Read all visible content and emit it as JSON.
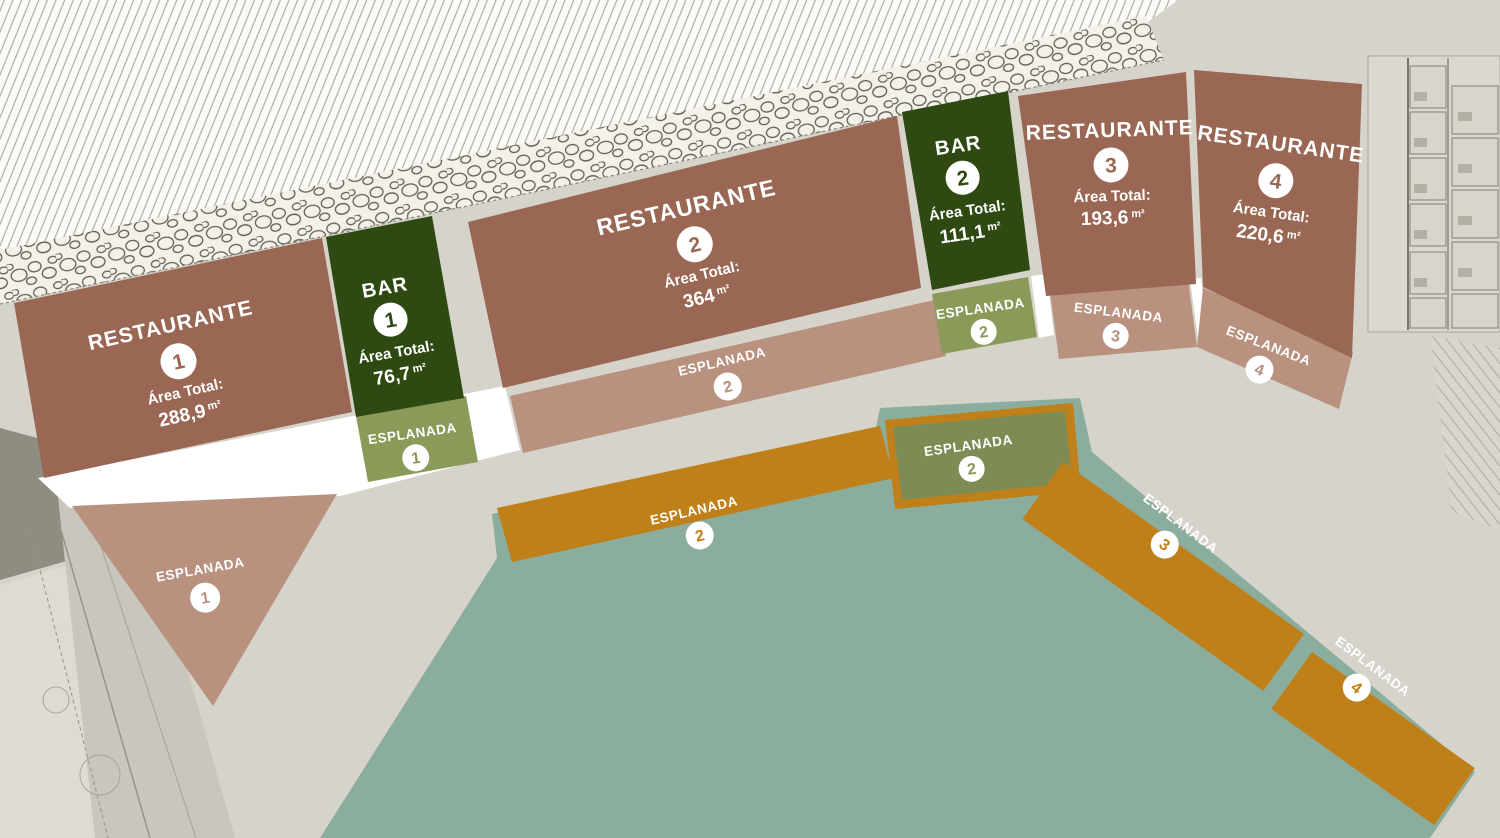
{
  "plan": {
    "zones": {
      "restaurante1": {
        "name": "RESTAURANTE",
        "number": "1",
        "area_label": "Área Total:",
        "area_value": "288,9",
        "area_unit": "m²"
      },
      "bar1": {
        "name": "BAR",
        "number": "1",
        "area_label": "Área Total:",
        "area_value": "76,7",
        "area_unit": "m²"
      },
      "restaurante2": {
        "name": "RESTAURANTE",
        "number": "2",
        "area_label": "Área Total:",
        "area_value": "364",
        "area_unit": "m²"
      },
      "bar2": {
        "name": "BAR",
        "number": "2",
        "area_label": "Área Total:",
        "area_value": "111,1",
        "area_unit": "m²"
      },
      "restaurante3": {
        "name": "RESTAURANTE",
        "number": "3",
        "area_label": "Área Total:",
        "area_value": "193,6",
        "area_unit": "m²"
      },
      "restaurante4": {
        "name": "RESTAURANTE",
        "number": "4",
        "area_label": "Área Total:",
        "area_value": "220,6",
        "area_unit": "m²"
      },
      "esplanada1_upper": {
        "name": "ESPLANADA",
        "number": "1"
      },
      "esplanada1_terrace": {
        "name": "ESPLANADA",
        "number": "1"
      },
      "esplanada2_strip": {
        "name": "ESPLANADA",
        "number": "2"
      },
      "esplanada2_upper": {
        "name": "ESPLANADA",
        "number": "2"
      },
      "esplanada3_strip": {
        "name": "ESPLANADA",
        "number": "3"
      },
      "esplanada4_strip": {
        "name": "ESPLANADA",
        "number": "4"
      },
      "esplanada2_orange": {
        "name": "ESPLANADA",
        "number": "2"
      },
      "esplanada2_olive": {
        "name": "ESPLANADA",
        "number": "2"
      },
      "esplanada3_orange": {
        "name": "ESPLANADA",
        "number": "3"
      },
      "esplanada4_orange": {
        "name": "ESPLANADA",
        "number": "4"
      }
    },
    "colors": {
      "restaurant_fill": "#996753",
      "bar_fill": "#2e4a12",
      "esplanada_pink_fill": "#b8917f",
      "esplanada_olive_fill": "#8a9a58",
      "esplanada_olive_dark_fill": "#7d8c55",
      "esplanada_orange_fill": "#bf8019",
      "water_fill": "#8bad9e",
      "background": "#d6d3cb",
      "walkway_white": "#ffffff"
    }
  }
}
